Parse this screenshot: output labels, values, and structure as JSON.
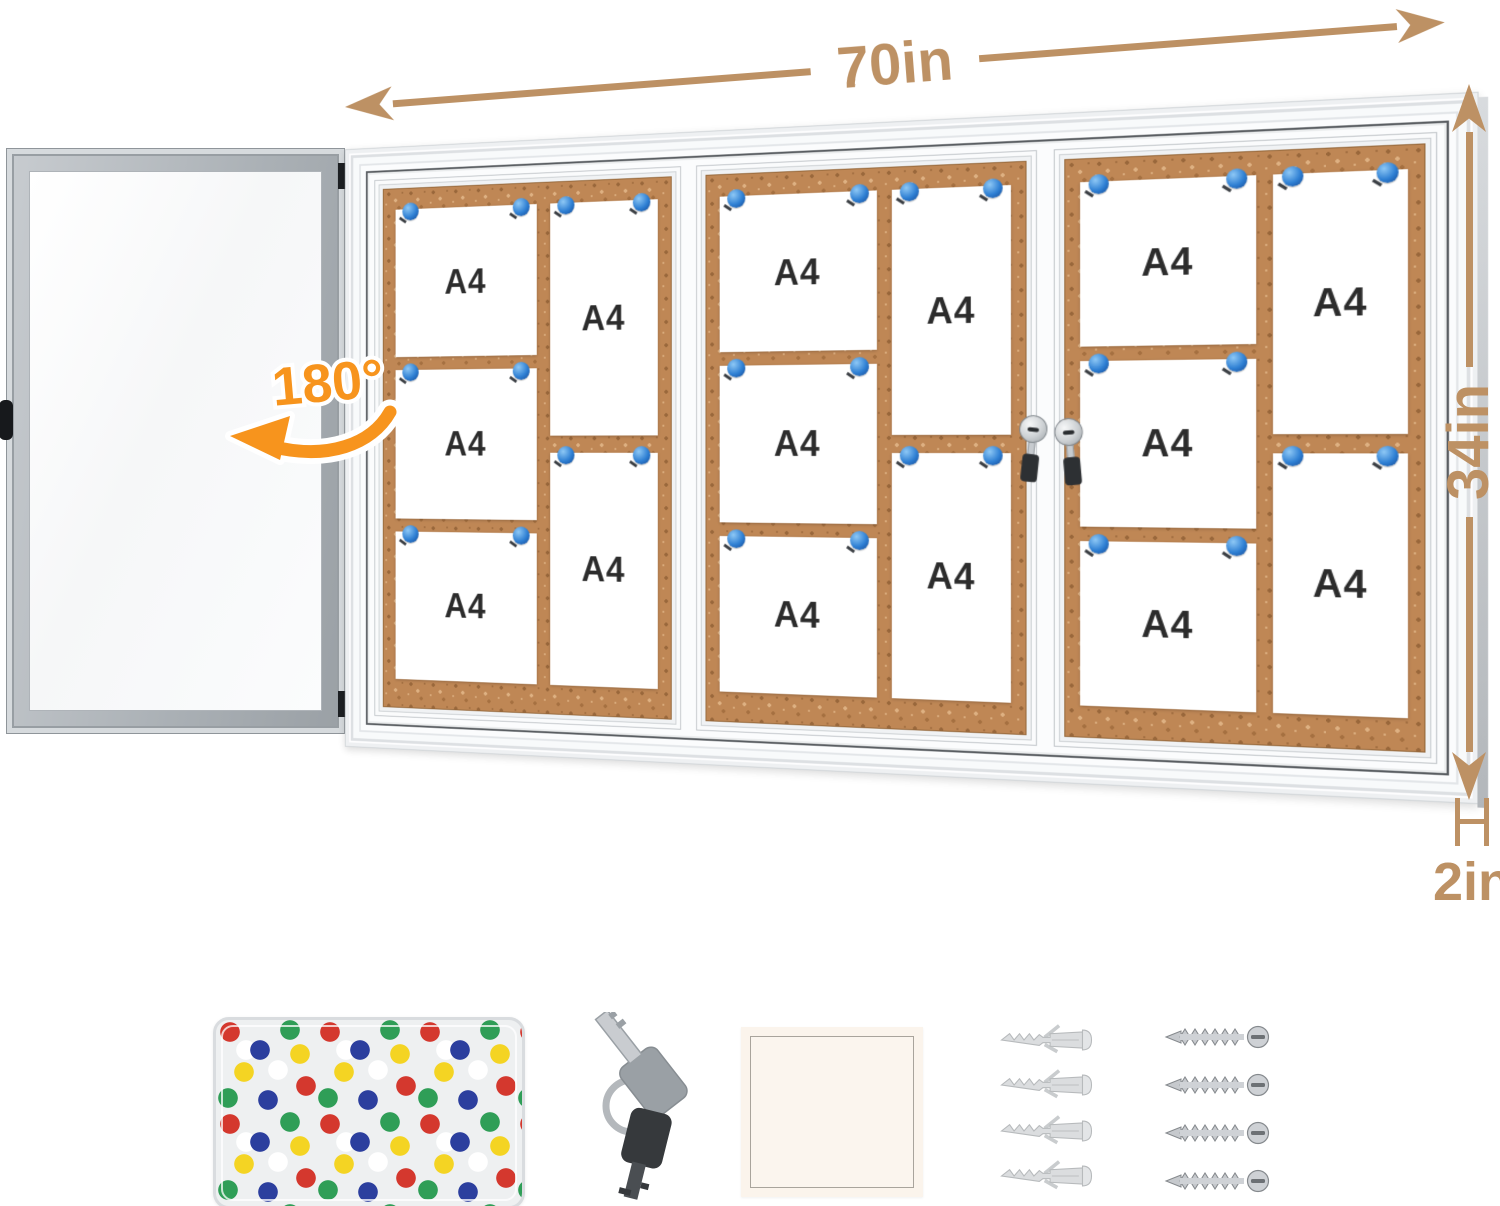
{
  "annotations": {
    "width": "70in",
    "height": "34in",
    "depth": "2in",
    "door_swing": "180°"
  },
  "board": {
    "paper_label": "A4",
    "panel_count": 3,
    "papers_per_panel": 5,
    "total_papers": 15
  },
  "colors": {
    "dimension_tan": "#bd9164",
    "swing_orange": "#f7941d",
    "cork_brown": "#bf8755",
    "pin_blue": "#2e7fd3"
  },
  "accessories": {
    "pin_box": {
      "icon": "push-pin-box-icon",
      "pin_colors": [
        "#d4382e",
        "#2c3f9e",
        "#2f9e57",
        "#f4d423",
        "#ffffff"
      ]
    },
    "keys": {
      "icon": "keys-icon",
      "count": 2
    },
    "pad": {
      "icon": "white-square-pad-icon"
    },
    "wall_anchors": {
      "icon": "wall-anchor-icon",
      "count": 4
    },
    "screws": {
      "icon": "screw-icon",
      "count": 4
    }
  }
}
